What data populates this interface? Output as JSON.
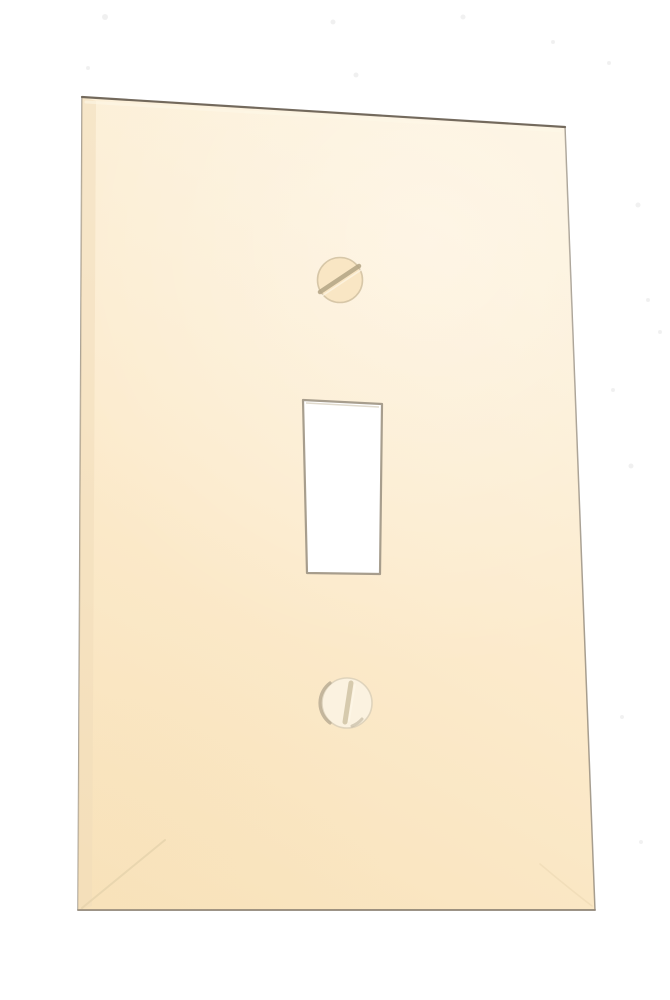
{
  "scene": {
    "type": "product-photo",
    "subject": "Single-gang toggle light switch wall plate",
    "finish": "ivory / light almond smooth plastic",
    "background": "plain white",
    "orientation": "plate slightly rotated clockwise; top edge slopes down to the right"
  },
  "objects": {
    "wall_plate": {
      "label": "wall plate"
    },
    "toggle_cutout": {
      "label": "toggle switch cutout"
    },
    "top_screw": {
      "label": "top mounting screw, slot tilted diagonally"
    },
    "bottom_screw": {
      "label": "bottom mounting screw, slot near vertical"
    }
  },
  "colors": {
    "background": "#ffffff",
    "plate_light": "#fdf2dd",
    "plate_mid": "#fcebcd",
    "plate_deep": "#f8e2ba",
    "plate_outline": "#8a8072",
    "plate_outline_top": "#6b6254",
    "edge_highlight": "#fef7e8",
    "left_bevel_shadow": "#f0dcba",
    "crease": "#e6d3ad",
    "sheen": "#ffffff",
    "cutout_fill": "#ffffff",
    "cutout_outline": "#9d9383",
    "cutout_inner_shadow": "#c8bda6",
    "screw_top_fill": "#f9e6c4",
    "screw_top_rim": "#d0c0a0",
    "screw_top_slot": "#b3a384",
    "screw_bottom_fill": "#fbf2e0",
    "screw_bottom_rim": "#d8cdb6",
    "screw_bottom_rim_dark": "#b2a68d",
    "screw_bottom_slot": "#cdbfa0",
    "speckle": "#a9a9a9"
  }
}
